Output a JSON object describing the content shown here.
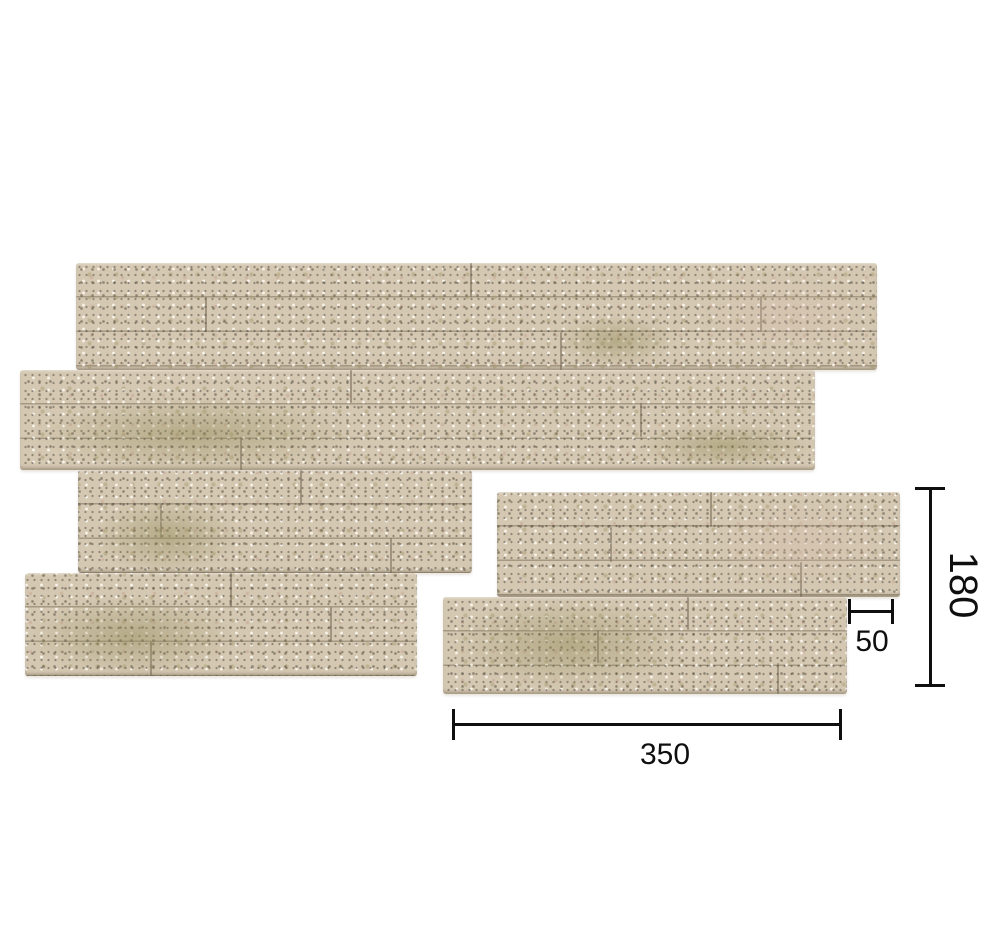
{
  "colors": {
    "background": "#ffffff",
    "stone_base": "#d4c8b2",
    "stone_light": "#e6ddcc",
    "stone_olive": "#a99d74",
    "stone_speck_dark": "#574f3f",
    "dim_line": "#0f0f0f",
    "label_text": "#0f0f0f"
  },
  "annotations": {
    "width_mm": "350",
    "height_mm": "180",
    "step_mm": "50"
  }
}
